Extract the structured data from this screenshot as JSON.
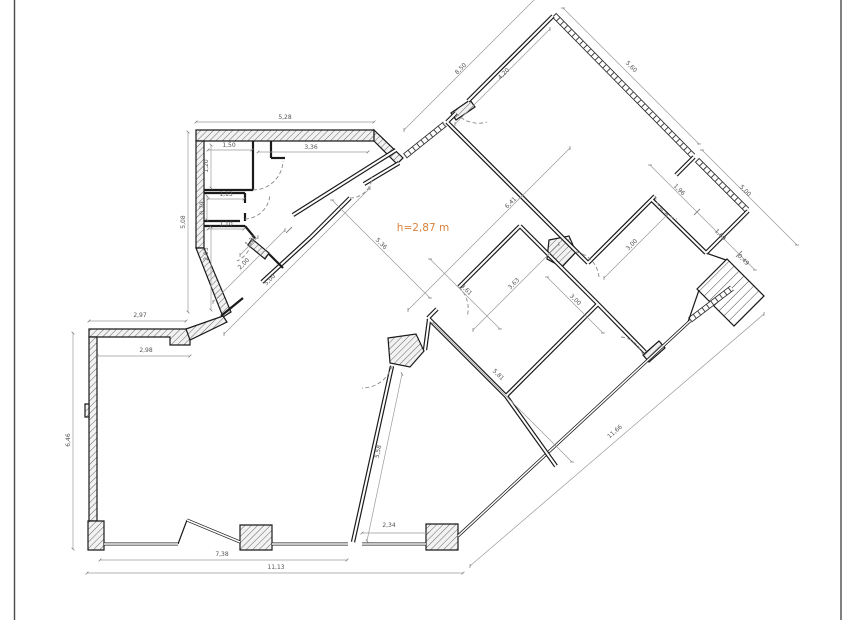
{
  "plan": {
    "note": {
      "text": "h=2,87 m"
    },
    "colors": {
      "accent": "#d9813f",
      "wall": "#1a1a1a",
      "dimension_line": "#9a9a9a",
      "dimension_text": "#555555",
      "background": "#ffffff"
    },
    "dimensions": [
      {
        "text": "5,28",
        "x": 285,
        "y": 119,
        "rot": 0
      },
      {
        "text": "1,50",
        "x": 229,
        "y": 147,
        "rot": 0
      },
      {
        "text": "3,36",
        "x": 311,
        "y": 149,
        "rot": 0
      },
      {
        "text": "1,20",
        "x": 208,
        "y": 166,
        "rot": -90
      },
      {
        "text": "5,08",
        "x": 185,
        "y": 222,
        "rot": -90
      },
      {
        "text": "1,13",
        "x": 226,
        "y": 196,
        "rot": 0
      },
      {
        "text": "0,79",
        "x": 204,
        "y": 208,
        "rot": -90
      },
      {
        "text": "1,10",
        "x": 226,
        "y": 226,
        "rot": 0
      },
      {
        "text": "2,03",
        "x": 208,
        "y": 254,
        "rot": -90
      },
      {
        "text": "1,38",
        "x": 252,
        "y": 242,
        "rot": -45
      },
      {
        "text": "2,00",
        "x": 245,
        "y": 265,
        "rot": -45
      },
      {
        "text": "5,00",
        "x": 271,
        "y": 281,
        "rot": -45
      },
      {
        "text": "8,50",
        "x": 462,
        "y": 70,
        "rot": -45
      },
      {
        "text": "4,20",
        "x": 505,
        "y": 75,
        "rot": -45
      },
      {
        "text": "5,60",
        "x": 630,
        "y": 68,
        "rot": 45
      },
      {
        "text": "5,00",
        "x": 744,
        "y": 192,
        "rot": 45
      },
      {
        "text": "1,96",
        "x": 678,
        "y": 191,
        "rot": 45
      },
      {
        "text": "1,69",
        "x": 719,
        "y": 236,
        "rot": 45
      },
      {
        "text": "0,49",
        "x": 742,
        "y": 261,
        "rot": 45
      },
      {
        "text": "3,00",
        "x": 633,
        "y": 246,
        "rot": -45
      },
      {
        "text": "6,41",
        "x": 512,
        "y": 204,
        "rot": -45
      },
      {
        "text": "5,36",
        "x": 380,
        "y": 245,
        "rot": 45
      },
      {
        "text": "3,61",
        "x": 465,
        "y": 291,
        "rot": 45
      },
      {
        "text": "3,63",
        "x": 515,
        "y": 285,
        "rot": -45
      },
      {
        "text": "3,00",
        "x": 574,
        "y": 301,
        "rot": 45
      },
      {
        "text": "5,81",
        "x": 497,
        "y": 376,
        "rot": 45
      },
      {
        "text": "11,66",
        "x": 616,
        "y": 433,
        "rot": -41
      },
      {
        "text": "5,58",
        "x": 380,
        "y": 452,
        "rot": -78
      },
      {
        "text": "2,34",
        "x": 389,
        "y": 527,
        "rot": 0
      },
      {
        "text": "7,38",
        "x": 222,
        "y": 556,
        "rot": 0
      },
      {
        "text": "11,13",
        "x": 276,
        "y": 569,
        "rot": 0
      },
      {
        "text": "2,97",
        "x": 140,
        "y": 317,
        "rot": 0
      },
      {
        "text": "2,98",
        "x": 146,
        "y": 352,
        "rot": 0
      },
      {
        "text": "6,46",
        "x": 70,
        "y": 440,
        "rot": -90
      }
    ]
  }
}
